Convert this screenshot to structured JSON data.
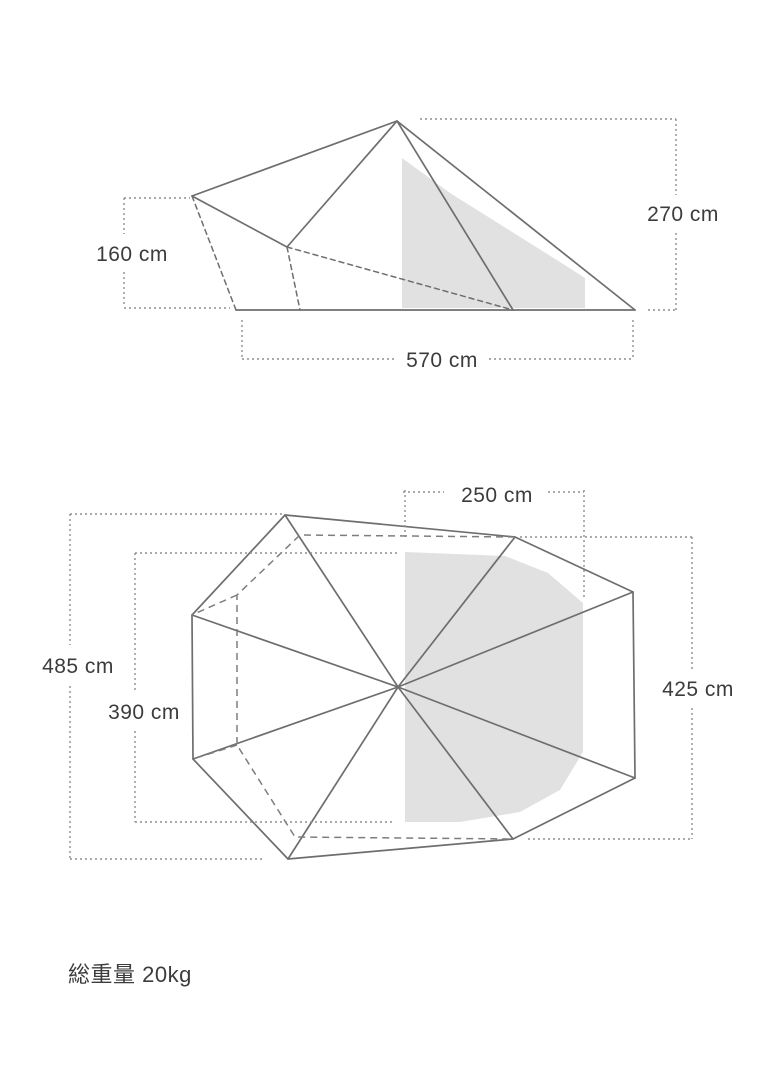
{
  "colors": {
    "background": "#ffffff",
    "tent_line": "#6e6e6e",
    "dashed_line": "#7d7d7d",
    "dimension_line": "#8f8f8f",
    "label_text": "#3c3c3c",
    "shaded_fill": "#e1e1e1"
  },
  "side_view": {
    "dimensions": {
      "peak_height": "270 cm",
      "side_height": "160 cm",
      "base_width": "570 cm"
    }
  },
  "top_view": {
    "dimensions": {
      "front_width": "250 cm",
      "overall_length": "485 cm",
      "inner_length": "390 cm",
      "side_width": "425 cm"
    }
  },
  "footer": {
    "total_weight": "総重量 20kg"
  }
}
